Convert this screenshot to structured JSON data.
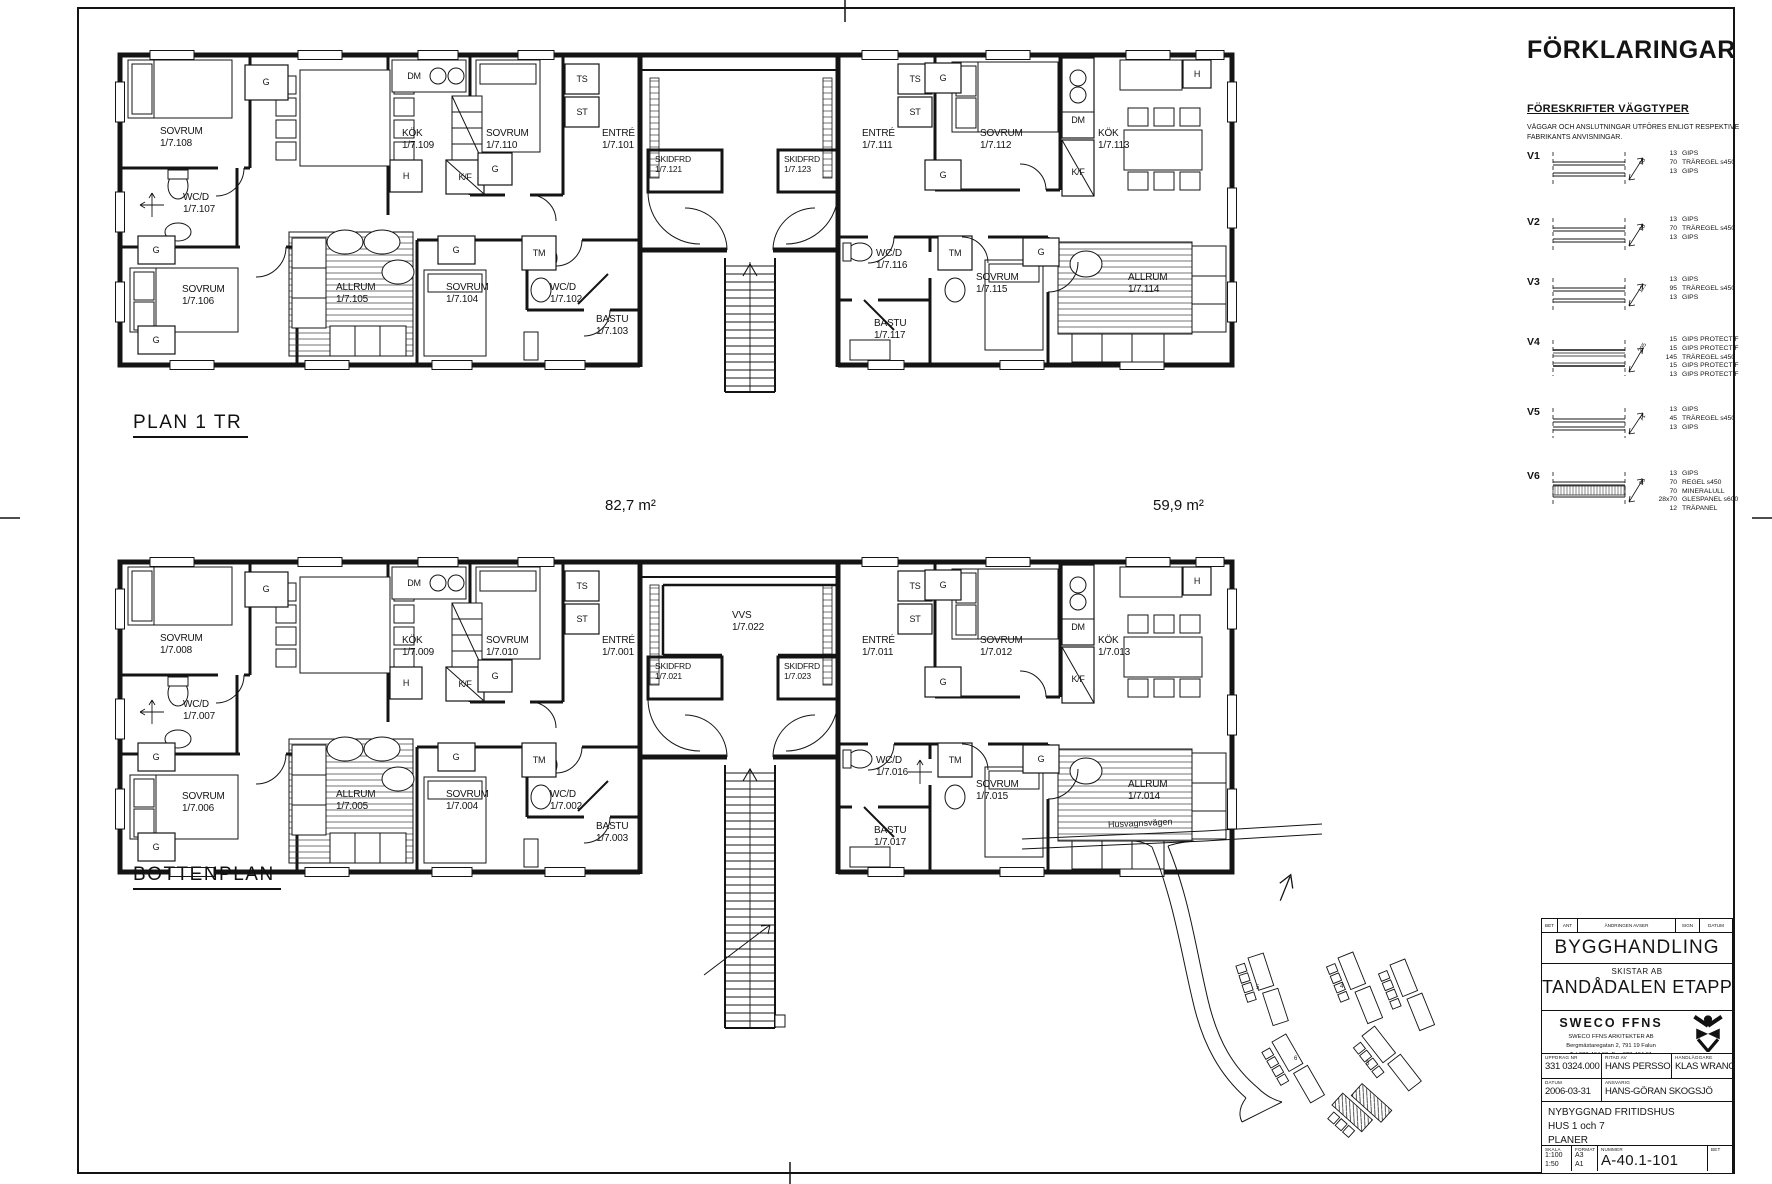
{
  "plans": {
    "plan1": {
      "title": "PLAN 1 TR"
    },
    "bottom": {
      "title": "BOTTENPLAN"
    },
    "area_left": "82,7 m²",
    "area_right": "59,9 m²"
  },
  "fix": {
    "g": "G",
    "ts": "TS",
    "st": "ST",
    "tm": "TM",
    "dm": "DM",
    "h": "H",
    "kf": "K/F"
  },
  "rooms1": {
    "sovrum108": {
      "n": "SOVRUM",
      "no": "1/7.108"
    },
    "kok109": {
      "n": "KÖK",
      "no": "1/7.109"
    },
    "sovrum110": {
      "n": "SOVRUM",
      "no": "1/7.110"
    },
    "entre101": {
      "n": "ENTRÉ",
      "no": "1/7.101"
    },
    "wcd107": {
      "n": "WC/D",
      "no": "1/7.107"
    },
    "sovrum106": {
      "n": "SOVRUM",
      "no": "1/7.106"
    },
    "allrum105": {
      "n": "ALLRUM",
      "no": "1/7.105"
    },
    "sovrum104": {
      "n": "SOVRUM",
      "no": "1/7.104"
    },
    "wcd102": {
      "n": "WC/D",
      "no": "1/7.102"
    },
    "bastu103": {
      "n": "BASTU",
      "no": "1/7.103"
    },
    "skidfrd121": {
      "n": "SKIDFRD",
      "no": "1/7.121"
    },
    "skidfrd123": {
      "n": "SKIDFRD",
      "no": "1/7.123"
    },
    "entre111": {
      "n": "ENTRÉ",
      "no": "1/7.111"
    },
    "sovrum112": {
      "n": "SOVRUM",
      "no": "1/7.112"
    },
    "kok113": {
      "n": "KÖK",
      "no": "1/7.113"
    },
    "wcd116": {
      "n": "WC/D",
      "no": "1/7.116"
    },
    "sovrum115": {
      "n": "SOVRUM",
      "no": "1/7.115"
    },
    "allrum114": {
      "n": "ALLRUM",
      "no": "1/7.114"
    },
    "bastu117": {
      "n": "BASTU",
      "no": "1/7.117"
    }
  },
  "rooms0": {
    "sovrum008": {
      "n": "SOVRUM",
      "no": "1/7.008"
    },
    "kok009": {
      "n": "KÖK",
      "no": "1/7.009"
    },
    "sovrum010": {
      "n": "SOVRUM",
      "no": "1/7.010"
    },
    "entre001": {
      "n": "ENTRÉ",
      "no": "1/7.001"
    },
    "wcd007": {
      "n": "WC/D",
      "no": "1/7.007"
    },
    "sovrum006": {
      "n": "SOVRUM",
      "no": "1/7.006"
    },
    "allrum005": {
      "n": "ALLRUM",
      "no": "1/7.005"
    },
    "sovrum004": {
      "n": "SOVRUM",
      "no": "1/7.004"
    },
    "wcd002": {
      "n": "WC/D",
      "no": "1/7.002"
    },
    "bastu003": {
      "n": "BASTU",
      "no": "1/7.003"
    },
    "skidfrd021": {
      "n": "SKIDFRD",
      "no": "1/7.021"
    },
    "skidfrd023": {
      "n": "SKIDFRD",
      "no": "1/7.023"
    },
    "vvs022": {
      "n": "VVS",
      "no": "1/7.022"
    },
    "entre011": {
      "n": "ENTRÉ",
      "no": "1/7.011"
    },
    "sovrum012": {
      "n": "SOVRUM",
      "no": "1/7.012"
    },
    "kok013": {
      "n": "KÖK",
      "no": "1/7.013"
    },
    "wcd016": {
      "n": "WC/D",
      "no": "1/7.016"
    },
    "sovrum015": {
      "n": "SOVRUM",
      "no": "1/7.015"
    },
    "allrum014": {
      "n": "ALLRUM",
      "no": "1/7.014"
    },
    "bastu017": {
      "n": "BASTU",
      "no": "1/7.017"
    }
  },
  "legend": {
    "title": "FÖRKLARINGAR",
    "subtitle": "FÖRESKRIFTER VÄGGTYPER",
    "note1": "VÄGGAR OCH ANSLUTNINGAR UTFÖRES ENLIGT RESPEKTIVE",
    "note2": "FABRIKANTS ANVISNINGAR.",
    "items": [
      {
        "code": "V1",
        "dim": "96",
        "layers": [
          {
            "t": "13",
            "d": "GIPS"
          },
          {
            "t": "70",
            "d": "TRÄREGEL s450"
          },
          {
            "t": "13",
            "d": "GIPS"
          }
        ]
      },
      {
        "code": "V2",
        "dim": "96",
        "layers": [
          {
            "t": "13",
            "d": "GIPS"
          },
          {
            "t": "70",
            "d": "TRÄREGEL s450"
          },
          {
            "t": "13",
            "d": "GIPS"
          }
        ]
      },
      {
        "code": "V3",
        "dim": "121",
        "layers": [
          {
            "t": "13",
            "d": "GIPS"
          },
          {
            "t": "95",
            "d": "TRÄREGEL s450"
          },
          {
            "t": "13",
            "d": "GIPS"
          }
        ]
      },
      {
        "code": "V4",
        "dim": "205",
        "layers": [
          {
            "t": "15",
            "d": "GIPS PROTECT F"
          },
          {
            "t": "15",
            "d": "GIPS PROTECT F"
          },
          {
            "t": "145",
            "d": "TRÄREGEL s450"
          },
          {
            "t": "15",
            "d": "GIPS PROTECT F"
          },
          {
            "t": "13",
            "d": "GIPS PROTECT F"
          }
        ]
      },
      {
        "code": "V5",
        "dim": "71",
        "layers": [
          {
            "t": "13",
            "d": "GIPS"
          },
          {
            "t": "45",
            "d": "TRÄREGEL s450"
          },
          {
            "t": "13",
            "d": "GIPS"
          }
        ]
      },
      {
        "code": "V6",
        "dim": "95",
        "layers": [
          {
            "t": "13",
            "d": "GIPS"
          },
          {
            "t": "70",
            "d": "REGEL s450"
          },
          {
            "t": "70",
            "d": "MINERALULL"
          },
          {
            "t": "28x70",
            "d": "GLESPANEL s600"
          },
          {
            "t": "12",
            "d": "TRÄPANEL"
          }
        ]
      }
    ]
  },
  "site": {
    "road": "Husvagnsvägen",
    "lot5": "5",
    "lot6": "6",
    "lot4": "4",
    "lot3": "3"
  },
  "tb": {
    "rev_headers": [
      "BET",
      "ANT",
      "ÄNDRINGEN AVSER",
      "SIGN",
      "DATUM"
    ],
    "doc_type": "BYGGHANDLING",
    "client": "SKISTAR AB",
    "project": "TANDÅDALEN ETAPP I",
    "company": "SWECO FFNS",
    "company_sub": "SWECO FFNS ARKITEKTER AB",
    "address": "Bergmästaregatan 2, 791 19 Falun",
    "phone": "Tel 023-464 60, Fax 023-464 61",
    "uppdrag_label": "UPPDRAG NR",
    "uppdrag": "331 0324.000",
    "ritad_label": "RITAD AV",
    "ritad": "HANS PERSSON",
    "hand_label": "HANDLÄGGARE",
    "hand": "KLAS WRANGE",
    "datum_label": "DATUM",
    "datum": "2006-03-31",
    "ansv_label": "ANSVARIG",
    "ansv": "HANS-GÖRAN SKOGSJÖ",
    "desc1": "NYBYGGNAD FRITIDSHUS",
    "desc2": "HUS 1 och 7",
    "desc3": "PLANER",
    "skala_label": "SKALA",
    "skala1": "1:100",
    "skala2": "1:50",
    "format_label": "FORMAT",
    "format1": "A3",
    "format2": "A1",
    "nummer_label": "NUMMER",
    "nummer": "A-40.1-101",
    "bet_label": "BET"
  }
}
